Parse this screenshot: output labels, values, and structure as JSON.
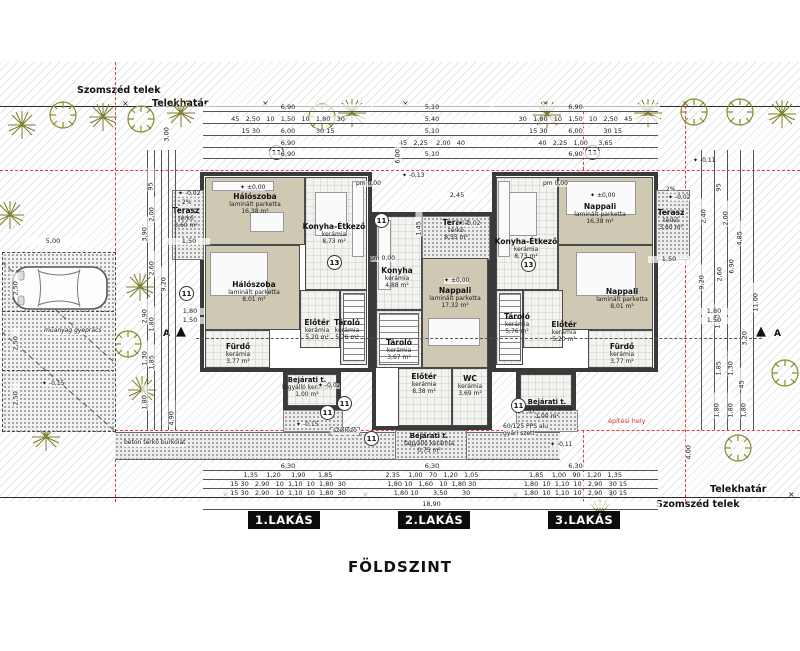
{
  "title": "FÖLDSZINT",
  "site": {
    "top_neighbor": "Szomszéd telek",
    "top_border": "Telekhatár",
    "bottom_border": "Telekhatár",
    "bottom_neighbor": "Szomszéd telek"
  },
  "apartments": [
    {
      "label": "1.LAKÁS",
      "rooms": [
        {
          "name": "Terasz",
          "material": "térkő",
          "area": "3,60 m²"
        },
        {
          "name": "Hálószoba",
          "material": "laminált parketta",
          "area": "16,38 m²"
        },
        {
          "name": "Konyha-Étkező",
          "material": "kerámia",
          "area": "8,73 m²"
        },
        {
          "name": "Hálószoba",
          "material": "laminált parketta",
          "area": "8,01 m²"
        },
        {
          "name": "Előtér",
          "material": "kerámia",
          "area": "5,20 m²"
        },
        {
          "name": "Tároló",
          "material": "kerámia",
          "area": "5,76 m²"
        },
        {
          "name": "Fürdő",
          "material": "kerámia",
          "area": "3,77 m²"
        },
        {
          "name": "Bejárati t.",
          "material": "fagyálló kerámia",
          "area": "1,00 m²"
        }
      ]
    },
    {
      "label": "2.LAKÁS",
      "rooms": [
        {
          "name": "Terasz",
          "material": "térkő",
          "area": "8,55 m²"
        },
        {
          "name": "Konyha",
          "material": "kerámia",
          "area": "4,88 m²"
        },
        {
          "name": "Nappali",
          "material": "laminált parketta",
          "area": "17,32 m²"
        },
        {
          "name": "Tároló",
          "material": "kerámia",
          "area": "3,67 m²"
        },
        {
          "name": "Előtér",
          "material": "kerámia",
          "area": "8,38 m²"
        },
        {
          "name": "WC",
          "material": "kerámia",
          "area": "3,69 m²"
        },
        {
          "name": "Bejárati t.",
          "material": "fagyálló kerámia",
          "area": "0,75 m²"
        }
      ]
    },
    {
      "label": "3.LAKÁS",
      "rooms": [
        {
          "name": "Terasz",
          "material": "térkő",
          "area": "3,60 m²"
        },
        {
          "name": "Nappali",
          "material": "laminált parketta",
          "area": "16,38 m²"
        },
        {
          "name": "Konyha-Étkező",
          "material": "kerámia",
          "area": "8,73 m²"
        },
        {
          "name": "Nappali",
          "material": "laminált parketta",
          "area": "8,01 m²"
        },
        {
          "name": "Előtér",
          "material": "kerámia",
          "area": "5,20 m²"
        },
        {
          "name": "Tároló",
          "material": "kerámia",
          "area": "5,76 m²"
        },
        {
          "name": "Fürdő",
          "material": "kerámia",
          "area": "3,77 m²"
        },
        {
          "name": "Bejárati t.",
          "material": "fagyálló kerámia",
          "area": "1,00 m²"
        }
      ]
    }
  ],
  "levels": {
    "pm": "pm 0,00",
    "zero": "±0,00",
    "m02": "-0,02",
    "m11": "-0,11",
    "m13": "-0,13",
    "m15": "-0,15",
    "slope": "2%"
  },
  "notes": {
    "ppsz1": "60/125 PPS alu",
    "ppsz2": "gyári szett",
    "szellozo": "szellőző",
    "epitesi": "építési hely",
    "beton": "beton térkő burkolat",
    "gyep": "műanyag gyeprács"
  },
  "tags": {
    "t11": "11",
    "t13": "13",
    "section": "A"
  },
  "icons": {
    "level_mark": "✦",
    "x_mark": "×",
    "triangle_up": "▲"
  },
  "dims": {
    "t1l": "6,90",
    "t1m": "5,10",
    "t1r": "6,90",
    "t2l": "45   2,50   10   1,50   10   1,80   30",
    "t2m": "5,40",
    "t2r": "30   1,80   10   1,50   10   2,50   45",
    "t3l": "15 30          6,00          30 15",
    "t3m": "5,10",
    "t3r": "15 30          6,00          30 15",
    "t4l": "6,90",
    "t4m": "45   2,25    2,00   40",
    "t4r": "40   2,25   1,00     3,65",
    "t5l": "6,90",
    "t5m": "5,10",
    "t5r": "6,90",
    "b1l": "6,30",
    "b1m": "6,30",
    "b1r": "6,30",
    "b2l": "1,35    1,20     1,90      1,85",
    "b2m": "2,35    1,00   70   1,20   1,05",
    "b2r": "1,85    1,00   90   1,20   1,35",
    "b3l": "15 30   2,90   10  1,10  10  1,80  30",
    "b3m": "1,80 10   1,60   10  1,80 30",
    "b3r": "1,80  10  1,10  10   2,90   30 15",
    "b4l": "15 30   2,90   10  1,10  10  1,80  30",
    "b4m": "1,80 10       3,50       30",
    "b4r": "1,80  10  1,10  10   2,90   30 15",
    "total": "18,90",
    "w245": "2,45",
    "h145": "1,45",
    "w150": "1,50",
    "v300": "3,00",
    "v600": "6,00",
    "v400": "4,00",
    "p500": "5,00",
    "p250": "2,50",
    "pair180": "1,80",
    "pair150": "1,50"
  },
  "lchain": [
    "95",
    "2,00",
    "3,90",
    "2,60",
    "9,20",
    "2,90",
    "1,80",
    "1,30",
    "1,85",
    "1,80",
    "4,90"
  ],
  "rchain": [
    "95",
    "2,40",
    "2,00",
    "4,85",
    "6,90",
    "2,60",
    "9,20",
    "11,00",
    "1,80",
    "3,20",
    "1,85",
    "1,30",
    "45",
    "1,80",
    "1,80",
    "1,80"
  ]
}
